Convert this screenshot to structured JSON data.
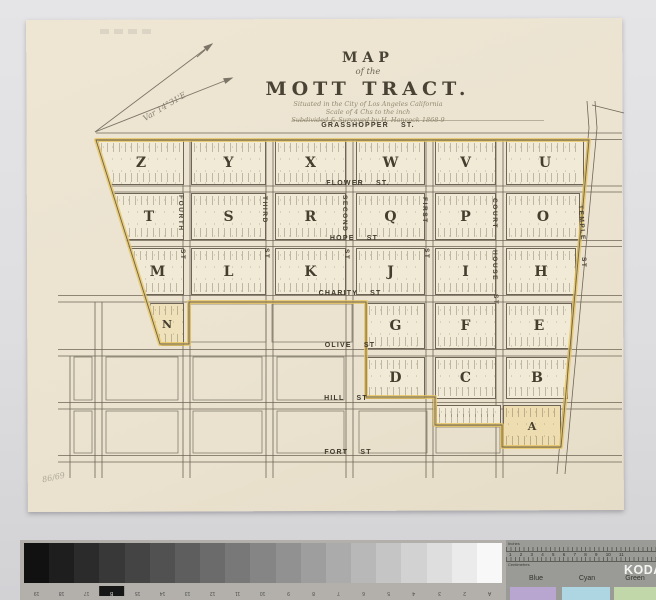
{
  "map": {
    "title_line1": "MAP",
    "title_line2": "of the",
    "title_line3": "MOTT TRACT.",
    "subtitle1": "Situated in the City of Los Angeles California",
    "subtitle2": "Scale of 4 Chs to the inch",
    "subtitle3": "Subdivided & Surveyed by H. Hancock 1868-9",
    "variation_note": "Var 14°31'E",
    "pencil_note": "86/69"
  },
  "streets": {
    "horizontal": [
      "GRASSHOPPER ST.",
      "FLOWER ST.",
      "HOPE ST",
      "CHARITY ST",
      "OLIVE ST",
      "HILL ST",
      "FORT ST"
    ],
    "vertical": [
      {
        "w1": "FOURTH",
        "w2": "",
        "st": "ST"
      },
      {
        "w1": "THIRD",
        "w2": "",
        "st": "ST"
      },
      {
        "w1": "SECOND",
        "w2": "",
        "st": "ST"
      },
      {
        "w1": "FIRST",
        "w2": "",
        "st": "ST"
      },
      {
        "w1": "COURT",
        "w2": "HOUSE",
        "st": "ST"
      },
      {
        "w1": "TEMPLE",
        "w2": "",
        "st": "ST"
      }
    ]
  },
  "blocks": {
    "row1": [
      "Z",
      "Y",
      "X",
      "W",
      "V",
      "U"
    ],
    "row2": [
      "T",
      "S",
      "R",
      "Q",
      "P",
      "O"
    ],
    "row3": [
      "M",
      "L",
      "K",
      "J",
      "I",
      "H"
    ],
    "row4": [
      "N",
      "G",
      "F",
      "E"
    ],
    "row5": [
      "D",
      "C",
      "B"
    ],
    "row6": [
      "A"
    ]
  },
  "calibration": {
    "grayscale_labels": [
      "19",
      "18",
      "17",
      "B",
      "15",
      "14",
      "13",
      "12",
      "11",
      "10",
      "9",
      "8",
      "7",
      "6",
      "5",
      "4",
      "3",
      "2",
      "A"
    ],
    "kodak": {
      "brand": "KODAK",
      "inches_label": "Inches",
      "cm_label": "Centimetres",
      "cm_numbers": "1 2 3 4 5 6 7 8 9 10 11",
      "patch_labels": [
        "Blue",
        "Cyan",
        "Green"
      ]
    }
  },
  "colors": {
    "paper": "#ebe3d0",
    "tract_highlight": "#e7c45f",
    "map_line": "#6f6557",
    "patch_blue": "#b9a6d0",
    "patch_cyan": "#aed6e2",
    "patch_green": "#c1d7aa"
  }
}
